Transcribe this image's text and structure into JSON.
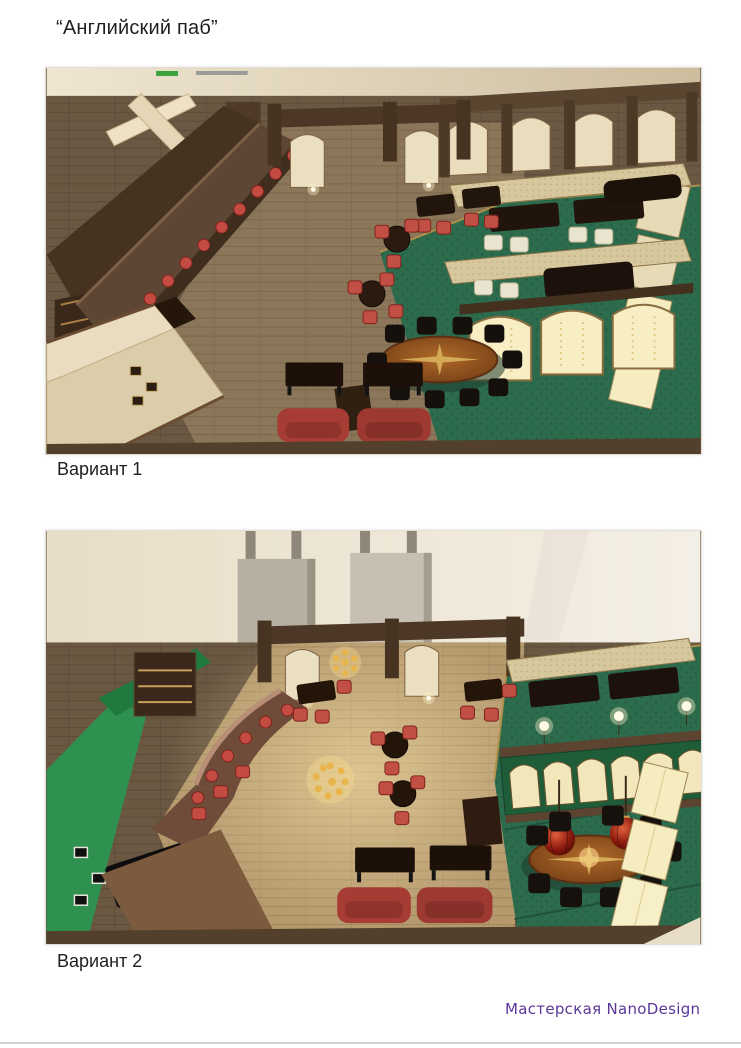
{
  "page": {
    "title": "“Английский паб”",
    "footer_credit": "Мастерская NanoDesign"
  },
  "figures": [
    {
      "caption": "Вариант 1",
      "description": "isometric-3d-render-pub-interior-variant-1"
    },
    {
      "caption": "Вариант 2",
      "description": "isometric-3d-render-pub-interior-variant-2"
    }
  ],
  "colors": {
    "footer_text": "#5a3798",
    "title_text": "#1f1f1f",
    "caption_text": "#1f1f1f",
    "floor_wood_dark": "#6a5843",
    "floor_wood_light": "#8b765a",
    "carpet_green": "#2d6b4d",
    "wall_cream": "#e9ddbd",
    "wall_green_accent": "#2f9150",
    "bar_wood": "#5d4633",
    "seat_red": "#c44b42",
    "sofa_red": "#a63c34",
    "table_black": "#1c1008",
    "oval_table_wood": "#a35c22",
    "lamp_red": "#8c1a0e",
    "exit_sign_green": "#3aa23a"
  }
}
